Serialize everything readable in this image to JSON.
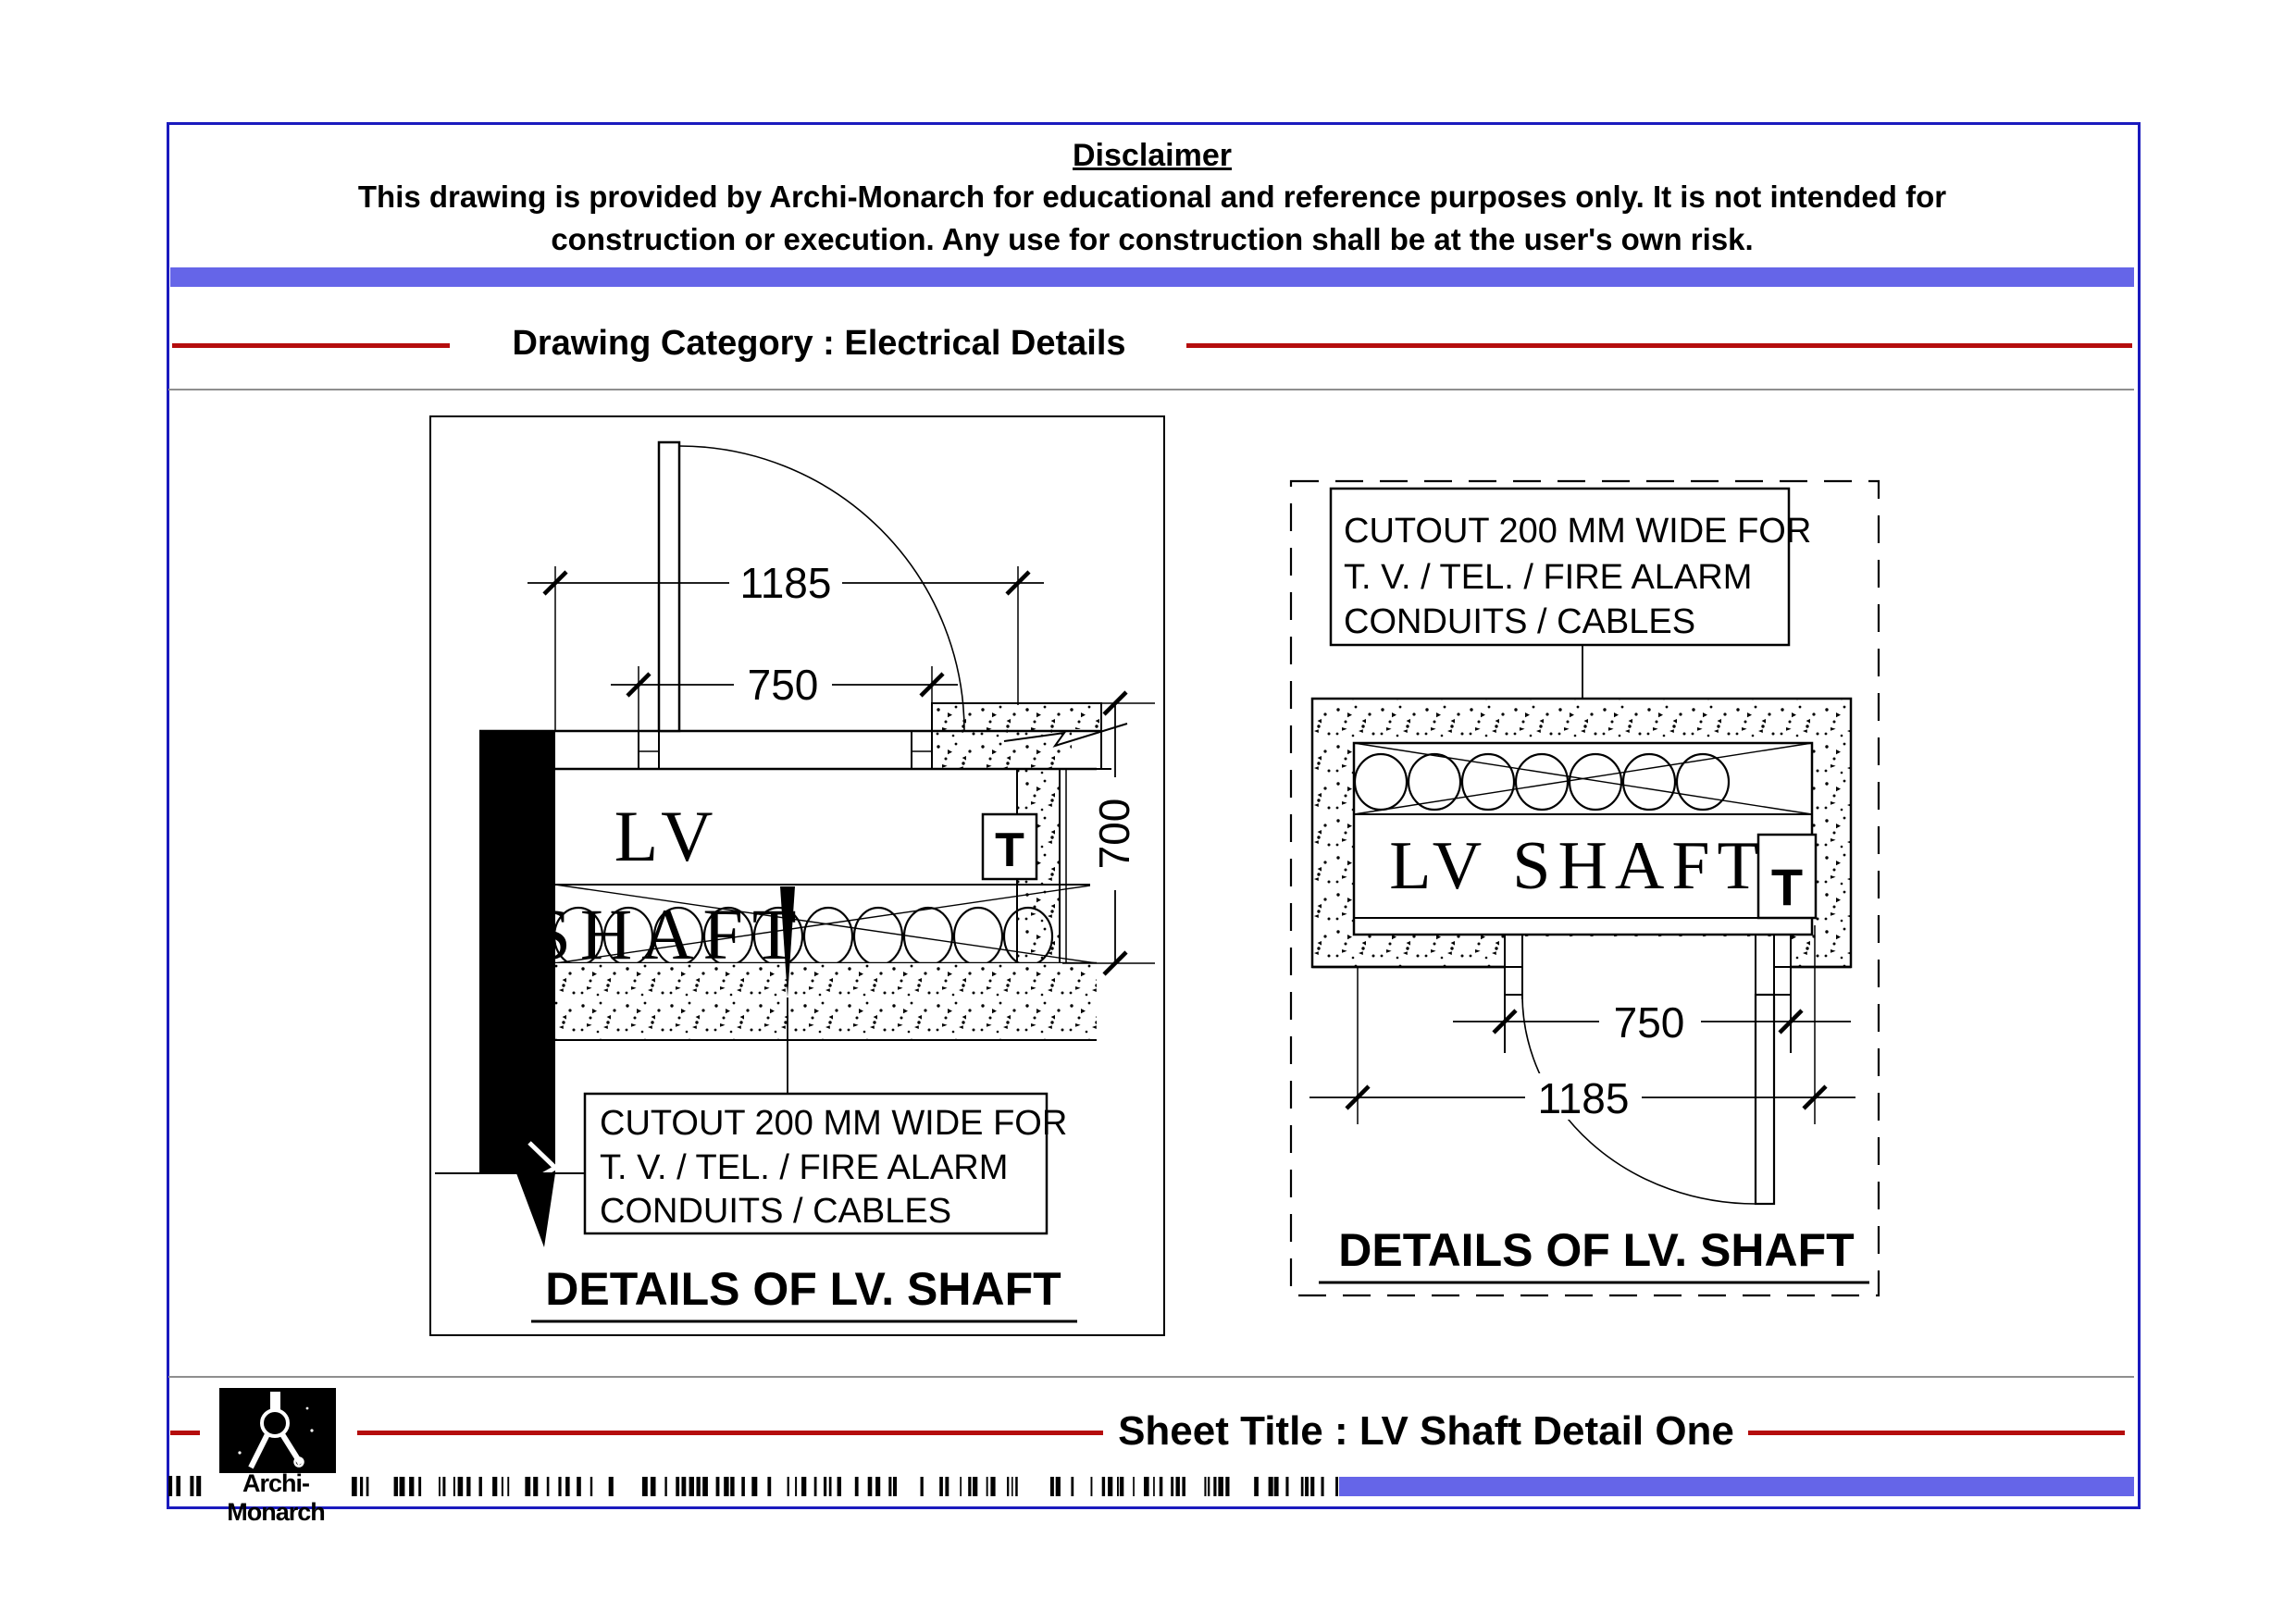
{
  "page": {
    "border_color": "#1a1abe",
    "band_color": "#6565e8",
    "red_color": "#b50d0d",
    "gray_color": "#8f8f8f"
  },
  "disclaimer": {
    "heading": "Disclaimer",
    "line1": "This drawing is provided by Archi-Monarch for educational and reference purposes only. It is not intended for",
    "line2": "construction or execution. Any use for construction shall be at the user's own risk."
  },
  "category_label": "Drawing Category : Electrical Details",
  "left_drawing": {
    "dim_overall": "1185",
    "dim_opening": "750",
    "dim_depth": "700",
    "shaft_line1": "LV",
    "shaft_line2": "SHAFT",
    "t_marker": "T",
    "cutout_line1": "CUTOUT 200 MM WIDE  FOR",
    "cutout_line2": "T. V. / TEL. / FIRE ALARM",
    "cutout_line3": "CONDUITS / CABLES",
    "title": "DETAILS OF LV. SHAFT"
  },
  "right_drawing": {
    "cutout_line1": "CUTOUT 200 MM WIDE  FOR",
    "cutout_line2": "T. V. / TEL. / FIRE ALARM",
    "cutout_line3": "CONDUITS / CABLES",
    "shaft_label": "LV SHAFT",
    "t_marker": "T",
    "dim_opening": "750",
    "dim_overall": "1185",
    "title": "DETAILS OF LV. SHAFT"
  },
  "footer": {
    "brand": "Archi-Monarch",
    "sheet_title": "Sheet Title : LV Shaft Detail One"
  }
}
